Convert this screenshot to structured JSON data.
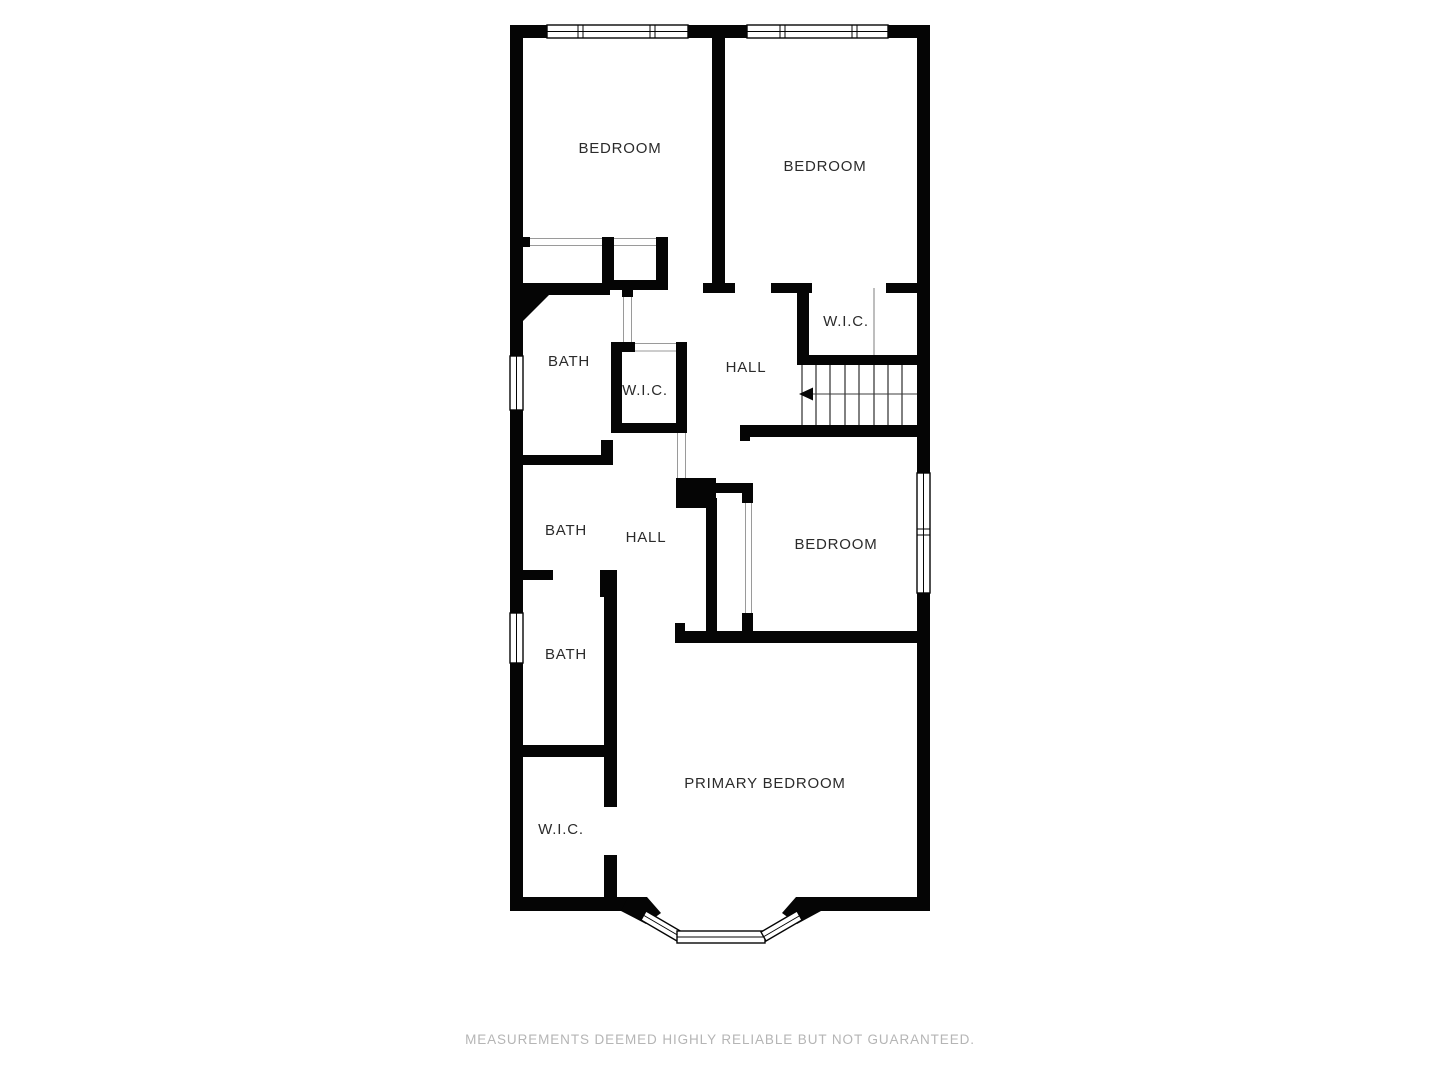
{
  "document_type": "floor-plan",
  "rooms": {
    "bedroom_top_left": "BEDROOM",
    "bedroom_top_right": "BEDROOM",
    "wic_top_right": "W.I.C.",
    "bath_upper": "BATH",
    "wic_middle": "W.I.C.",
    "hall_upper": "HALL",
    "bath_middle": "BATH",
    "hall_lower": "HALL",
    "bedroom_middle_right": "BEDROOM",
    "bath_lower": "BATH",
    "wic_bottom_left": "W.I.C.",
    "primary_bedroom": "PRIMARY BEDROOM"
  },
  "features": {
    "staircase": "stairs with direction arrow pointing left",
    "bay_window": "angled bay window at bottom of primary bedroom",
    "windows": "double-line windows on top wall (2), left wall (2), right wall (1 double)"
  },
  "colors": {
    "wall": "#050505",
    "background": "#ffffff",
    "room_label": "#2b2b2b",
    "disclaimer": "#b5b5b5",
    "opening_line": "#9a9a9a"
  },
  "footer": {
    "disclaimer": "MEASUREMENTS DEEMED HIGHLY RELIABLE BUT NOT GUARANTEED."
  }
}
